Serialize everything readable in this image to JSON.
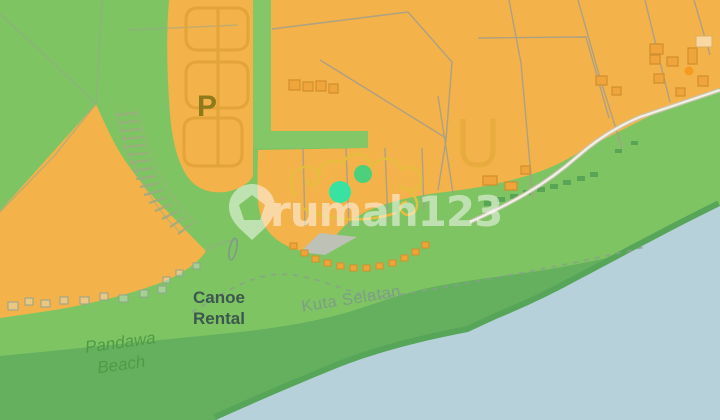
{
  "map": {
    "watermark": {
      "logo": "map-pin-house-icon",
      "text": "rumah123"
    },
    "labels": {
      "parking": "P",
      "canoe_rental": {
        "line1": "Canoe",
        "line2": "Rental"
      },
      "district": "Kuta Selatan",
      "beach": {
        "line1": "Pandawa",
        "line2": "Beach"
      }
    },
    "markers": [
      {
        "name": "listing-marker-primary",
        "color": "#38e3a1"
      },
      {
        "name": "listing-marker-secondary",
        "color": "#4cd07c"
      },
      {
        "name": "poi-dot-amber",
        "color": "#f69b1f"
      }
    ],
    "palette": {
      "water": "#b7d1da",
      "land_green": "#7ec463",
      "shore_green": "#64b05e",
      "shore_dark": "#56a559",
      "zone_orange": "#f4b24a",
      "road_green_strip": "#89cb6b",
      "decor_yellow": "#e7bd3e",
      "parking_letter": "#8f7a1a",
      "label_dark": "#3c584e",
      "label_district": "#7d9c88",
      "label_beach": "#4f9b45",
      "watermark_white": "#ffffff"
    }
  }
}
